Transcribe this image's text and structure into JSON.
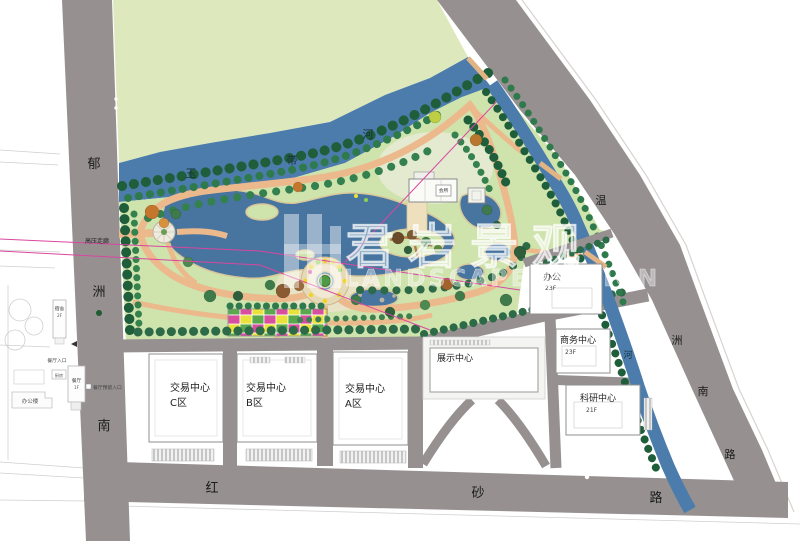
{
  "watermark": {
    "cn": "君岩景观",
    "en": "LANDSCAPE DESIGN"
  },
  "roads": {
    "west": {
      "chars": [
        "郁",
        "洲",
        "南"
      ]
    },
    "east": {
      "chars": [
        "温",
        "洲",
        "南",
        "路"
      ]
    },
    "south": {
      "chars": [
        "红",
        "砂",
        "路"
      ]
    }
  },
  "water": {
    "river_chars": [
      "玉",
      "带",
      "河"
    ],
    "canal_char": "河"
  },
  "park": {
    "clubhouse_label": "会所",
    "hv_corridor_label": "高压走廊"
  },
  "buildings": {
    "trade_c": {
      "name": "交易中心",
      "zone": "C区"
    },
    "trade_b": {
      "name": "交易中心",
      "zone": "B区"
    },
    "trade_a": {
      "name": "交易中心",
      "zone": "A区"
    },
    "exhibition": {
      "name": "展示中心"
    },
    "office": {
      "name": "办公",
      "floors": "23F"
    },
    "business": {
      "name": "商务中心",
      "floors": "23F"
    },
    "research": {
      "name": "科研中心",
      "floors": "21F"
    }
  },
  "context": {
    "dormitory": "宿舍",
    "dormitory_floors": "2F",
    "canteen_entrance": "餐厅入口",
    "kitchen": "厨房",
    "canteen": "餐厅",
    "canteen_floors": "1F",
    "canteen_reserved_entrance": "餐厅预留入口",
    "office_building": "办公楼"
  },
  "colors": {
    "road_gray": "#969091",
    "field_green": "#dde9bd",
    "river_blue": "#4b7cab",
    "lake_blue": "#47759f",
    "park_green": "#cfe3ad",
    "path_peach": "#ecb98d",
    "tree_dark": "#1f5e3a",
    "hv_pink": "#d946a0"
  }
}
